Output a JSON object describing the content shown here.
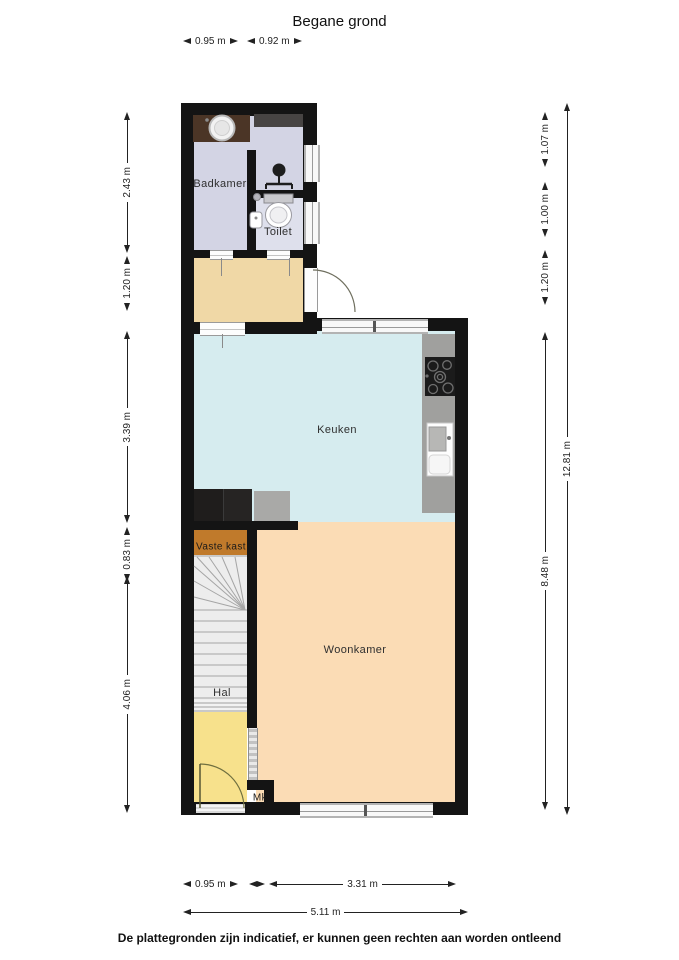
{
  "title": "Begane grond",
  "footer": "De plattegronden zijn indicatief, er kunnen geen rechten aan worden ontleend",
  "rooms": {
    "badkamer": "Badkamer",
    "toilet": "Toilet",
    "keuken": "Keuken",
    "vaste_kast": "Vaste kast",
    "hal": "Hal",
    "woonkamer": "Woonkamer",
    "mk": "Mk"
  },
  "dims": {
    "top": [
      "0.95 m",
      "0.92 m"
    ],
    "left": [
      "2.43 m",
      "1.20 m",
      "3.39 m",
      "0.83 m",
      "4.06 m"
    ],
    "right_inner": [
      "1.07 m",
      "1.00 m",
      "1.20 m",
      "8.48 m"
    ],
    "right_outer": "12.81 m",
    "bottom": [
      "0.95 m",
      "3.31 m"
    ],
    "bottom_total": "5.11 m"
  },
  "colors": {
    "wall": "#141414",
    "badkamer_floor": "#d3d4e4",
    "toilet_floor": "#dee0ec",
    "hal_floor": "#f0d8a6",
    "keuken_floor": "#d6ecef",
    "woonkamer_floor": "#fbdcb5",
    "vaste_kast_floor": "#c07a2b",
    "entree_floor": "#f7e18c",
    "stairs": "#ededed",
    "counter": "#a0a09e",
    "vanity": "#4b3526",
    "appliance": "#1f1d1c"
  }
}
